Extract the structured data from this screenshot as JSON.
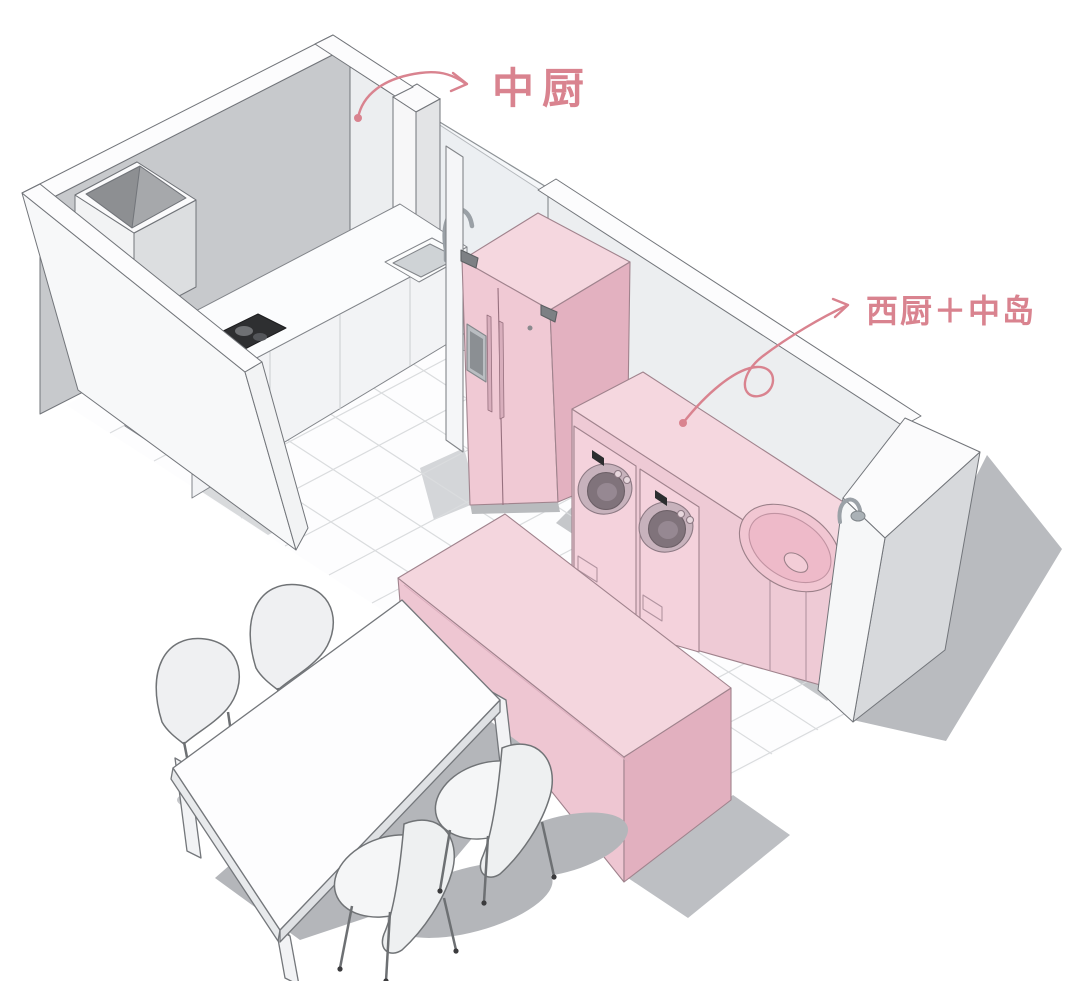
{
  "annotations": [
    {
      "id": "chinese-kitchen",
      "label": "中厨",
      "color": "#d9838f"
    },
    {
      "id": "western-kitchen-island",
      "label": "西厨＋中岛",
      "color": "#d9838f"
    }
  ],
  "scene": {
    "type": "3d-axonometric-kitchen-plan",
    "areas": [
      {
        "name": "chinese-kitchen",
        "label": "中厨"
      },
      {
        "name": "western-kitchen-with-island",
        "label": "西厨＋中岛"
      }
    ],
    "objects": [
      "walls",
      "glass-partition",
      "corner-duct",
      "kitchen-counter",
      "cooktop",
      "kitchen-sink",
      "sink-faucet",
      "refrigerator",
      "laundry-counter",
      "washing-machine",
      "washing-machine",
      "round-basin",
      "basin-faucet",
      "kitchen-island",
      "dining-table",
      "dining-chair",
      "dining-chair",
      "dining-chair",
      "dining-chair"
    ]
  },
  "palette": {
    "pink_top": "#f5d7df",
    "pink_front": "#f0c9d4",
    "pink_side": "#e3b1c0",
    "annotation_pink": "#d9838f",
    "wall_gray": "#c7c9cc",
    "wall_light": "#eceef0",
    "shadow_dark": "#b4b6ba",
    "shadow_mid": "#c6c8cb",
    "floor_line": "#dadcde",
    "outline": "#72757a"
  }
}
